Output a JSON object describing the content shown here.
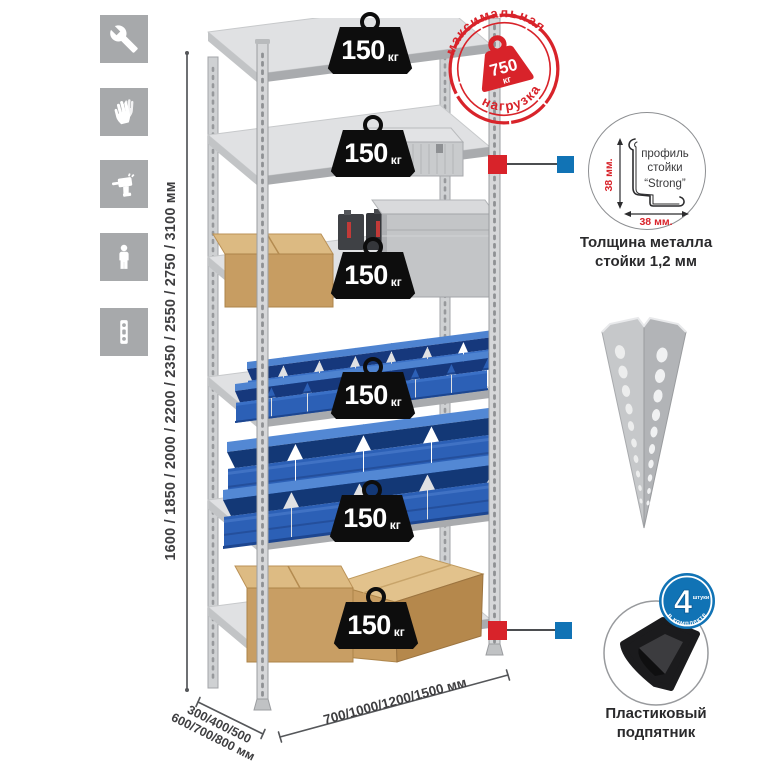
{
  "colors": {
    "accent_red": "#d8232a",
    "callout_blue": "#1173b5",
    "icon_tile_gray": "#a7a9ab",
    "metal_gray": "#c6c8ca",
    "bin_blue": "#2c60b6",
    "cardboard": "#c89e64"
  },
  "left_icons": [
    {
      "name": "wrench"
    },
    {
      "name": "work-gloves"
    },
    {
      "name": "drill"
    },
    {
      "name": "person-height"
    },
    {
      "name": "spirit-level"
    }
  ],
  "dimensions": {
    "height_label": "1600 / 1850 / 2000 / 2200 / 2350 / 2550 / 2750 / 3100 мм",
    "depth_label_line1": "300/400/500",
    "depth_label_line2": "600/700/800 мм",
    "width_label": "700/1000/1200/1500 мм"
  },
  "max_load_stamp": {
    "arc_top": "максимальная",
    "arc_bottom": "нагрузка",
    "value": "750",
    "unit": "кг"
  },
  "shelves": [
    {
      "load_value": "150",
      "load_unit": "кг",
      "contents": "empty"
    },
    {
      "load_value": "150",
      "load_unit": "кг",
      "contents": "aluminium-case"
    },
    {
      "load_value": "150",
      "load_unit": "кг",
      "contents": "cardboard-box-metal-case-canisters"
    },
    {
      "load_value": "150",
      "load_unit": "кг",
      "contents": "small-blue-bins"
    },
    {
      "load_value": "150",
      "load_unit": "кг",
      "contents": "large-blue-bins"
    },
    {
      "load_value": "150",
      "load_unit": "кг",
      "contents": "cardboard-boxes"
    }
  ],
  "profile_callout": {
    "labels": {
      "line1": "профиль",
      "line2": "стойки",
      "line3": "“Strong”"
    },
    "dim_vertical": "38 мм.",
    "dim_horizontal": "38 мм.",
    "caption_line1": "Толщина металла",
    "caption_line2": "стойки 1,2 мм"
  },
  "foot_callout": {
    "badge_value": "4",
    "badge_note": "штуки",
    "badge_arc": "в комплекте",
    "caption_line1": "Пластиковый",
    "caption_line2": "подпятник"
  }
}
